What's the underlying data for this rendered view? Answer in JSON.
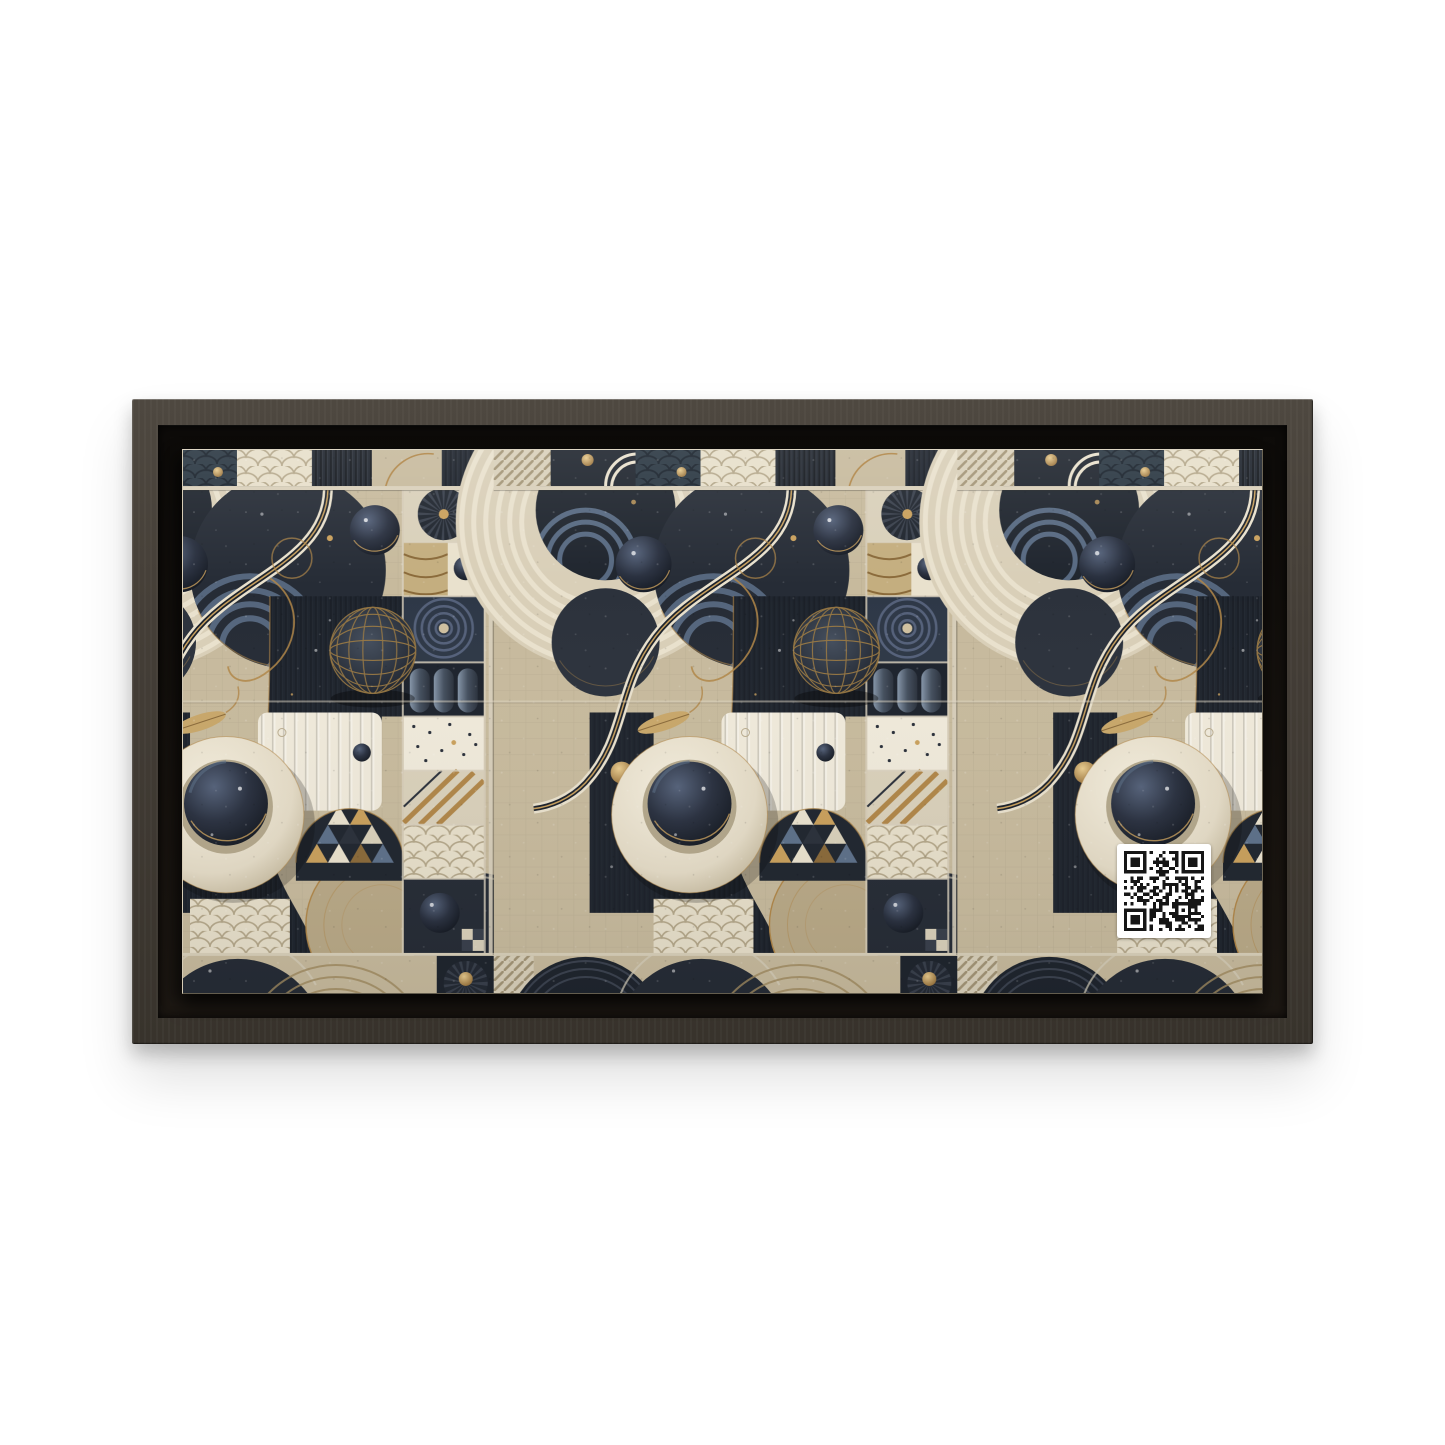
{
  "scene": {
    "type": "product-photo",
    "subject": "Horizontal framed canvas wall-art mockup",
    "background": "plain white studio backdrop"
  },
  "frame": {
    "style": "floating canvas frame with inner shadow gap",
    "finish": "dark espresso wood",
    "orientation": "horizontal 2:1"
  },
  "artwork": {
    "title": "Abstract geometric mixed-texture art in navy, beige, cream and gold",
    "pattern_repeats_horizontally": 3,
    "motifs": [
      "speckled navy circles",
      "cream concentric ring eclipse",
      "denim blue concentric arcs",
      "gold latitude-longitude grid sphere",
      "glossy navy spheres with gold rims",
      "cream donut with navy sphere center",
      "fish-scale quilted texture",
      "white vertical quilted ribs panel",
      "triangle mosaic arch",
      "radial pleated fan discs with gold buttons",
      "patchwork texture squares column",
      "striped ribbon wave",
      "gold leaf and wire curls",
      "top and bottom patchwork strips"
    ]
  },
  "qr_code": {
    "present": true,
    "position": "lower right of artwork",
    "modules": 25,
    "finder_corners": [
      "top-left",
      "top-right",
      "bottom-left"
    ]
  },
  "colors": {
    "page_bg": "#ffffff",
    "frame_face": "#443e37",
    "frame_face_light": "#4e4840",
    "frame_face_dark": "#38332c",
    "recess": "#17130f",
    "recess_dark": "#0d0b09",
    "beige": "#c7ba9d",
    "beige2": "#bfb193",
    "cream": "#e9e1cd",
    "cream2": "#d9d0ba",
    "white": "#efe9da",
    "navy": "#262c36",
    "navy2": "#1f252e",
    "navy3": "#2e3847",
    "denim": "#5d7089",
    "sand": "#b9a987",
    "gold": "#b08648",
    "gold2": "#c9a05c",
    "qr_bg": "#ffffff",
    "qr_fg": "#161616"
  }
}
